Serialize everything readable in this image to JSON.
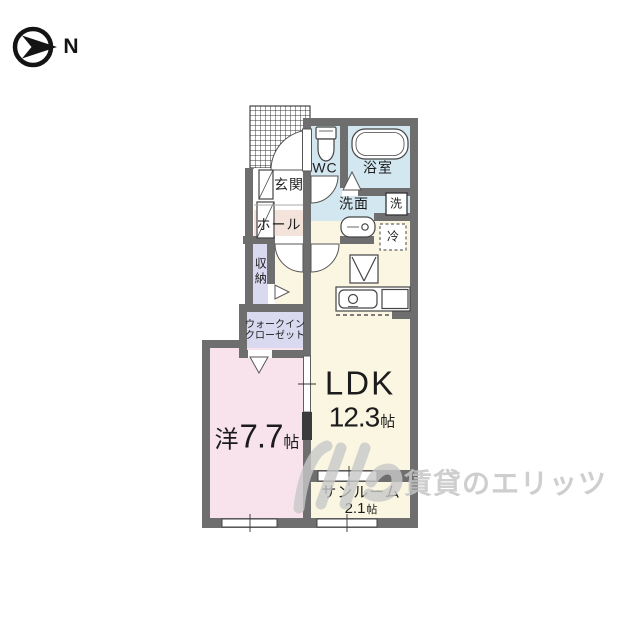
{
  "compass": {
    "north_label": "N"
  },
  "plan": {
    "rooms": {
      "entrance": "玄関",
      "hall": "ホール",
      "wc": "WC",
      "bathroom": "浴室",
      "washroom": "洗面",
      "washer": "洗",
      "fridge": "冷",
      "storage": "収納",
      "walk_in_closet_line1": "ウォークイン",
      "walk_in_closet_line2": "クローゼット",
      "bedroom_prefix": "洋",
      "bedroom_size": "7.7",
      "bedroom_unit": "帖",
      "ldk_label": "LDK",
      "ldk_size": "12.3",
      "ldk_unit": "帖",
      "sunroom_label": "サンルーム",
      "sunroom_size": "2.1",
      "sunroom_unit": "帖"
    },
    "colors": {
      "wall": "#6e6e6e",
      "wet_area": "#d2e7f0",
      "hall_floor": "#f3e3da",
      "closet": "#d9d9f0",
      "bedroom": "#f8e3ed",
      "ldk": "#faf6e2",
      "watermark": "#c6c6c6"
    }
  },
  "watermark": {
    "text": "賃貸のエリッツ"
  }
}
